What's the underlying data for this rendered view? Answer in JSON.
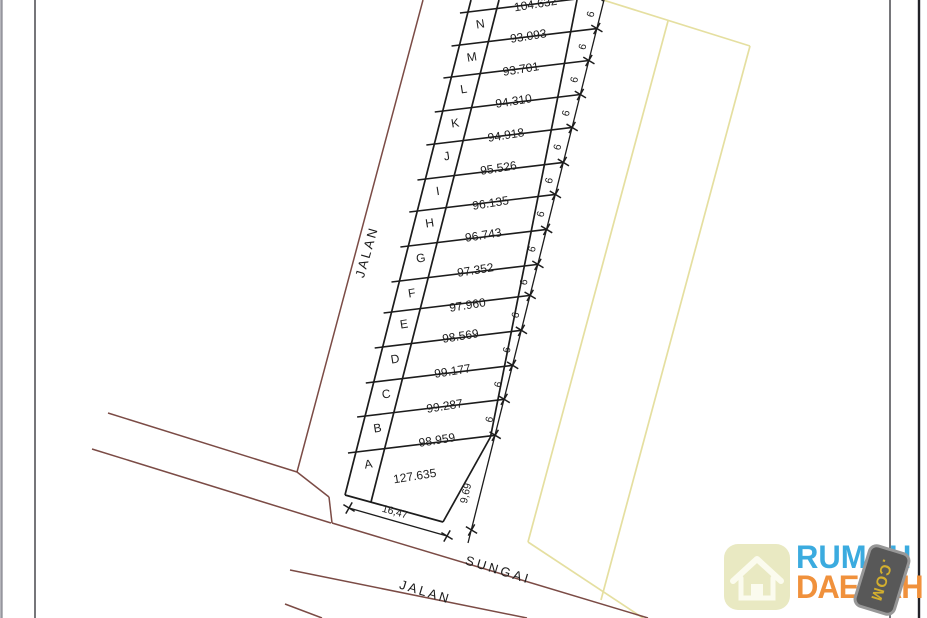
{
  "drawing": {
    "plots": [
      {
        "letter": "",
        "area": "104.632",
        "width": "6"
      },
      {
        "letter": "N",
        "area": "93.093",
        "width": "6"
      },
      {
        "letter": "M",
        "area": "93.701",
        "width": "6"
      },
      {
        "letter": "L",
        "area": "94.310",
        "width": "6"
      },
      {
        "letter": "K",
        "area": "94.918",
        "width": "6"
      },
      {
        "letter": "J",
        "area": "95.526",
        "width": "6"
      },
      {
        "letter": "I",
        "area": "96.135",
        "width": "6"
      },
      {
        "letter": "H",
        "area": "96.743",
        "width": "6"
      },
      {
        "letter": "G",
        "area": "97.352",
        "width": "6"
      },
      {
        "letter": "F",
        "area": "97.960",
        "width": "6"
      },
      {
        "letter": "E",
        "area": "98.569",
        "width": "6"
      },
      {
        "letter": "D",
        "area": "99.177",
        "width": "6"
      },
      {
        "letter": "C",
        "area": "99.287",
        "width": "6"
      },
      {
        "letter": "B",
        "area": "98.959",
        "width": "6"
      },
      {
        "letter": "A",
        "area": "127.635",
        "width": ""
      }
    ],
    "dimensions": {
      "bottom": "16,47",
      "right": "9,69"
    },
    "labels": {
      "road_left": "JALAN",
      "road_bottom": "JALAN",
      "river": "SUNGAI"
    },
    "colors": {
      "road": "#7b4b45",
      "parcel_yellow": "#e5dfa0",
      "line": "#1c1c1c"
    }
  },
  "watermark": {
    "line1": "RUMAH",
    "line2": "DAERAH",
    "badge": ".COM",
    "colors": {
      "line1": "#3babdf",
      "line2": "#f0913c",
      "badge_bg": "#585858",
      "badge_text": "#d3af2e",
      "house_bg": "#e9e9c2",
      "house_stroke": "#fbfbee"
    }
  }
}
